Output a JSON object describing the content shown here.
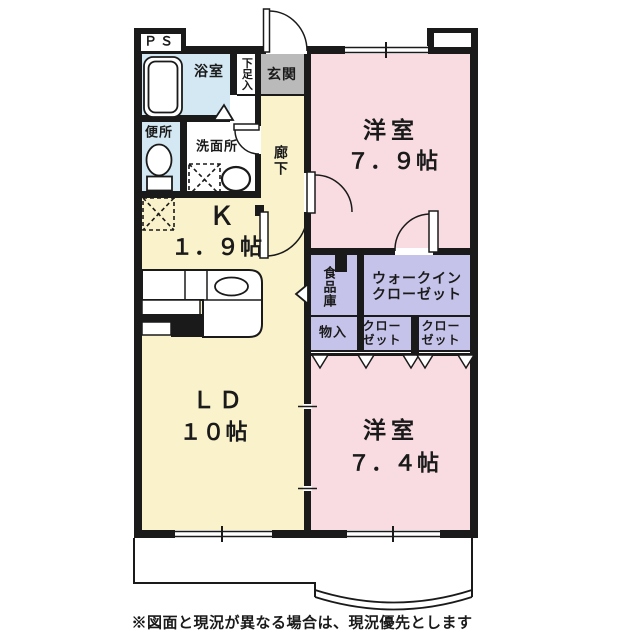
{
  "rooms": {
    "pipe_space": "ＰＳ",
    "bathroom": "浴室",
    "shoe_box": "下足入",
    "entrance": "玄関",
    "toilet": "便所",
    "washroom": "洗面所",
    "hallway": "廊下",
    "western1": {
      "name": "洋室",
      "size": "７．９帖"
    },
    "kitchen": {
      "name": "Ｋ",
      "size": "１．９帖"
    },
    "living": {
      "name": "ＬＤ",
      "size": "１０帖"
    },
    "pantry": "食品庫",
    "wic": {
      "line1": "ウォークイン",
      "line2": "クローゼット"
    },
    "storage": "物入",
    "closet": {
      "line1": "クロー",
      "line2": "ゼット"
    },
    "western2": {
      "name": "洋室",
      "size": "７．４帖"
    }
  },
  "note": "※図面と現況が異なる場合は、現況優先とします",
  "colors": {
    "room_pink": "#f8dce2",
    "floor_yellow": "#f9f2cb",
    "wet_area_blue": "#d3e8f3",
    "closet_purple": "#c6c3ea",
    "entrance_gray": "#bababa",
    "wall_black": "#1a1a1a"
  }
}
